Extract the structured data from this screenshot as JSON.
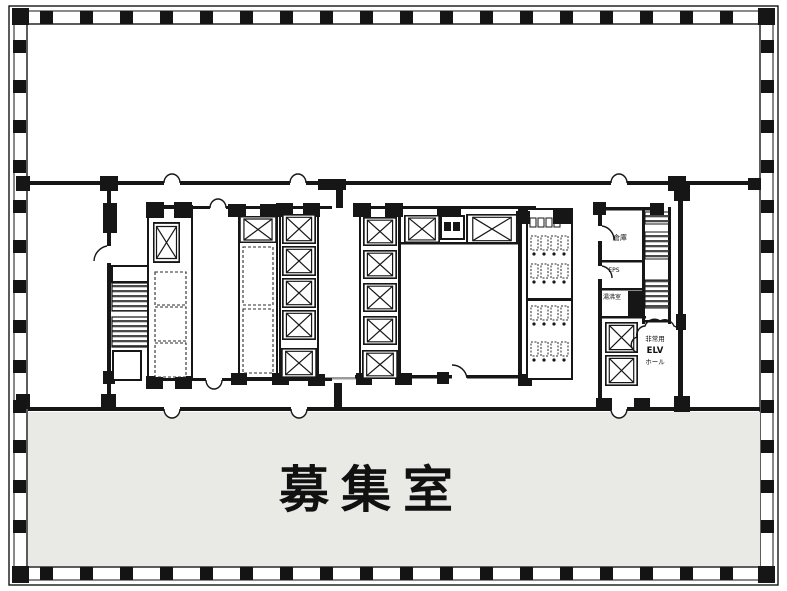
{
  "labels": {
    "main_room": "募集室",
    "elv_hall_line1": "非常用",
    "elv_hall_line2": "ELV",
    "elv_hall_line3": "ホール",
    "storage": "倉庫",
    "eps": "EPS",
    "kitchenette": "湯沸室"
  },
  "colors": {
    "ink": "#161616",
    "main_room_fill": "#e9e9e6",
    "background": "#ffffff",
    "stair_hatch": "#4a4a4a"
  }
}
